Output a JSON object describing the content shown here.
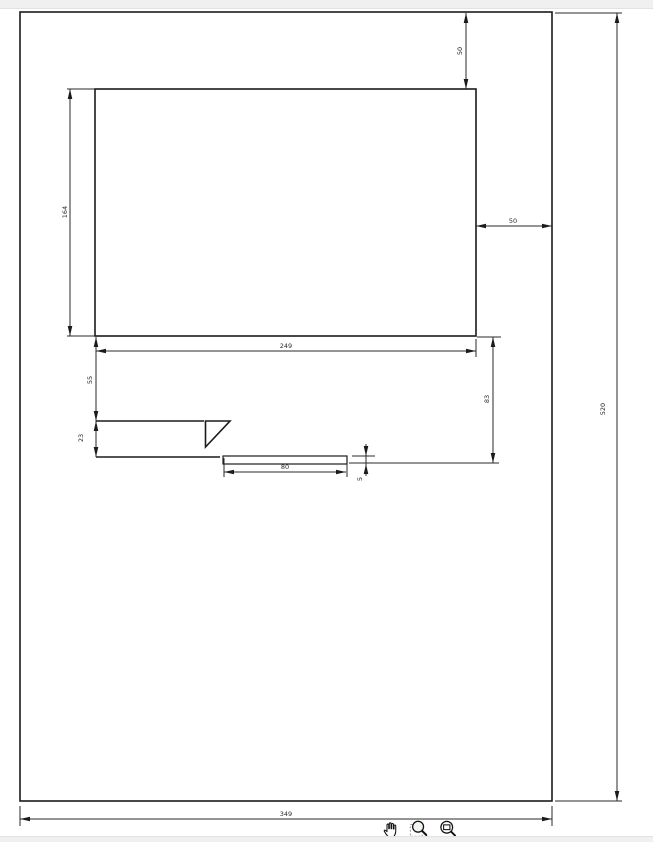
{
  "viewer": {
    "background_color": "#ffffff",
    "chrome_strip_color": "#f0f0f0",
    "geometry_line_color": "#1b1b1b",
    "dimension_line_color": "#2a2a2a"
  },
  "toolbar": {
    "icons": [
      "hand-pan-icon",
      "zoom-selection-icon",
      "zoom-fit-icon"
    ]
  },
  "drawing": {
    "dimensions": {
      "panel_top_offset": "50",
      "panel_right_offset": "50",
      "panel_height": "164",
      "panel_width": "249",
      "offset_below_panel": "55",
      "notch_height": "23",
      "lower_section_height": "83",
      "bar_length": "80",
      "bar_thickness": "5",
      "sheet_width": "349",
      "sheet_height": "520"
    }
  }
}
